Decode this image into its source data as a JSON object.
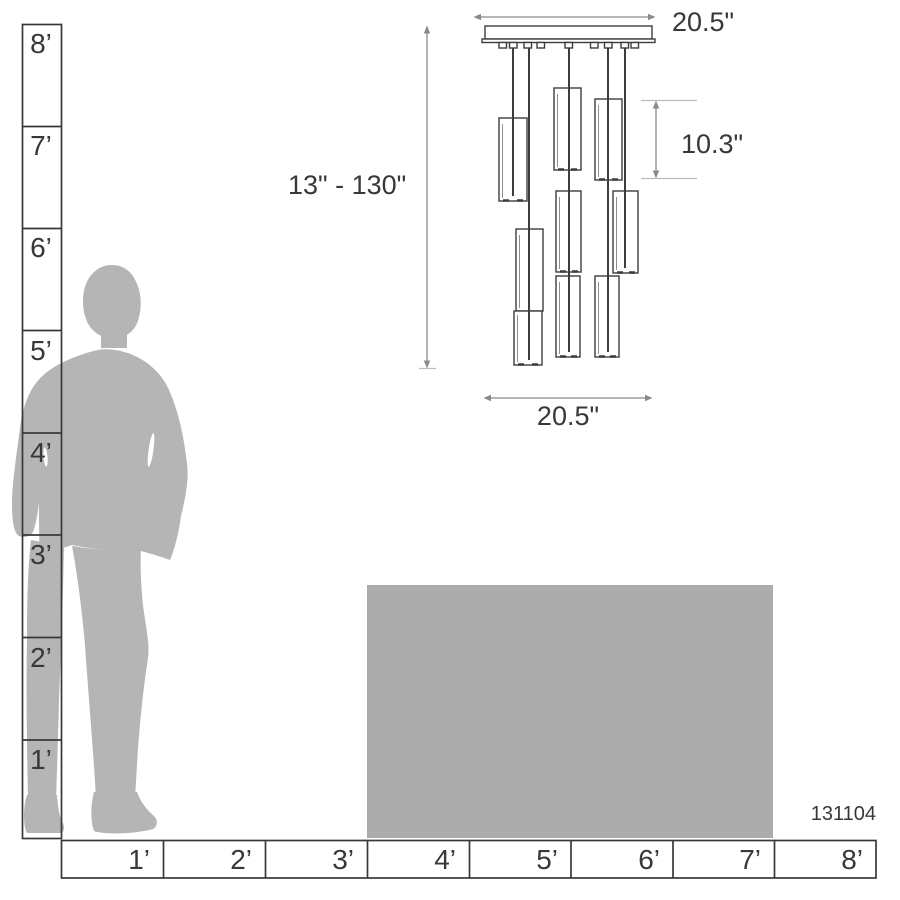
{
  "product": {
    "model_number": "131104"
  },
  "dimensions": {
    "canopy_width": {
      "label": "20.5\""
    },
    "height_range": {
      "label": "13\" - 130\""
    },
    "pendant_height": {
      "label": "10.3\""
    },
    "fixture_width": {
      "label": "20.5\""
    }
  },
  "rulers": {
    "vertical": {
      "labels": [
        "8’",
        "7’",
        "6’",
        "5’",
        "4’",
        "3’",
        "2’",
        "1’"
      ]
    },
    "horizontal": {
      "labels": [
        "1’",
        "2’",
        "3’",
        "4’",
        "5’",
        "6’",
        "7’",
        "8’"
      ]
    }
  },
  "figure": {
    "pendant_count": 9
  },
  "colors": {
    "silhouette": "#b5b5b5",
    "table": "#acacac",
    "line_dark": "#383838",
    "dimension_gray": "#8a8a8a"
  }
}
